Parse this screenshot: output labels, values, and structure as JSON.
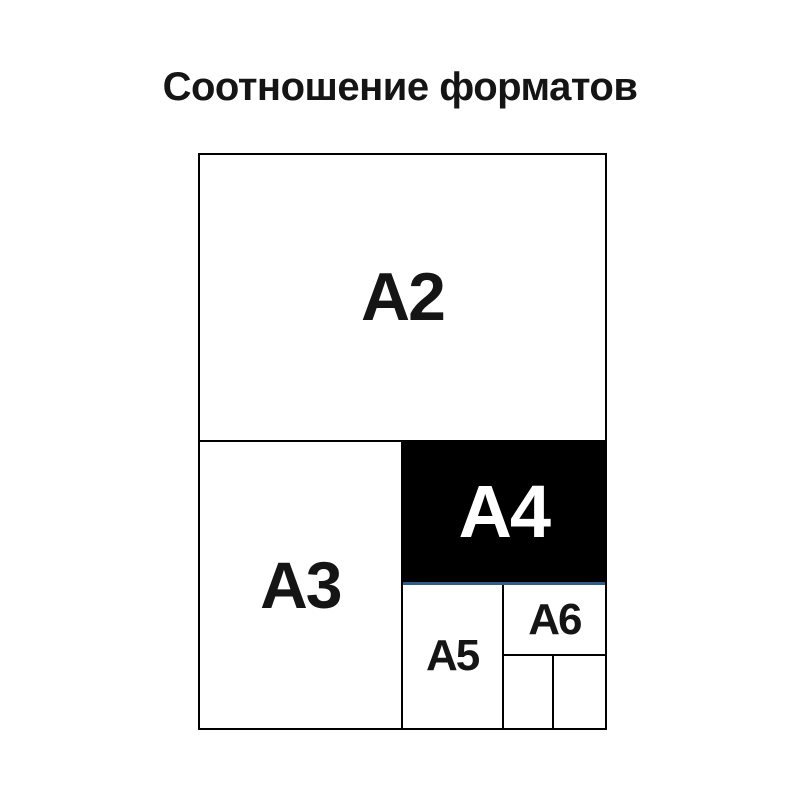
{
  "page": {
    "title": "Соотношение форматов"
  },
  "diagram": {
    "cells": {
      "a2": {
        "label": "A2"
      },
      "a3": {
        "label": "A3"
      },
      "a4": {
        "label": "A4"
      },
      "a5": {
        "label": "A5"
      },
      "a6": {
        "label": "A6"
      }
    },
    "colors": {
      "line": "#000000",
      "a4_fill": "#000000",
      "a4_text": "#ffffff",
      "a4_underline": "#2d5c8e",
      "text": "#151515",
      "background": "#ffffff"
    }
  }
}
